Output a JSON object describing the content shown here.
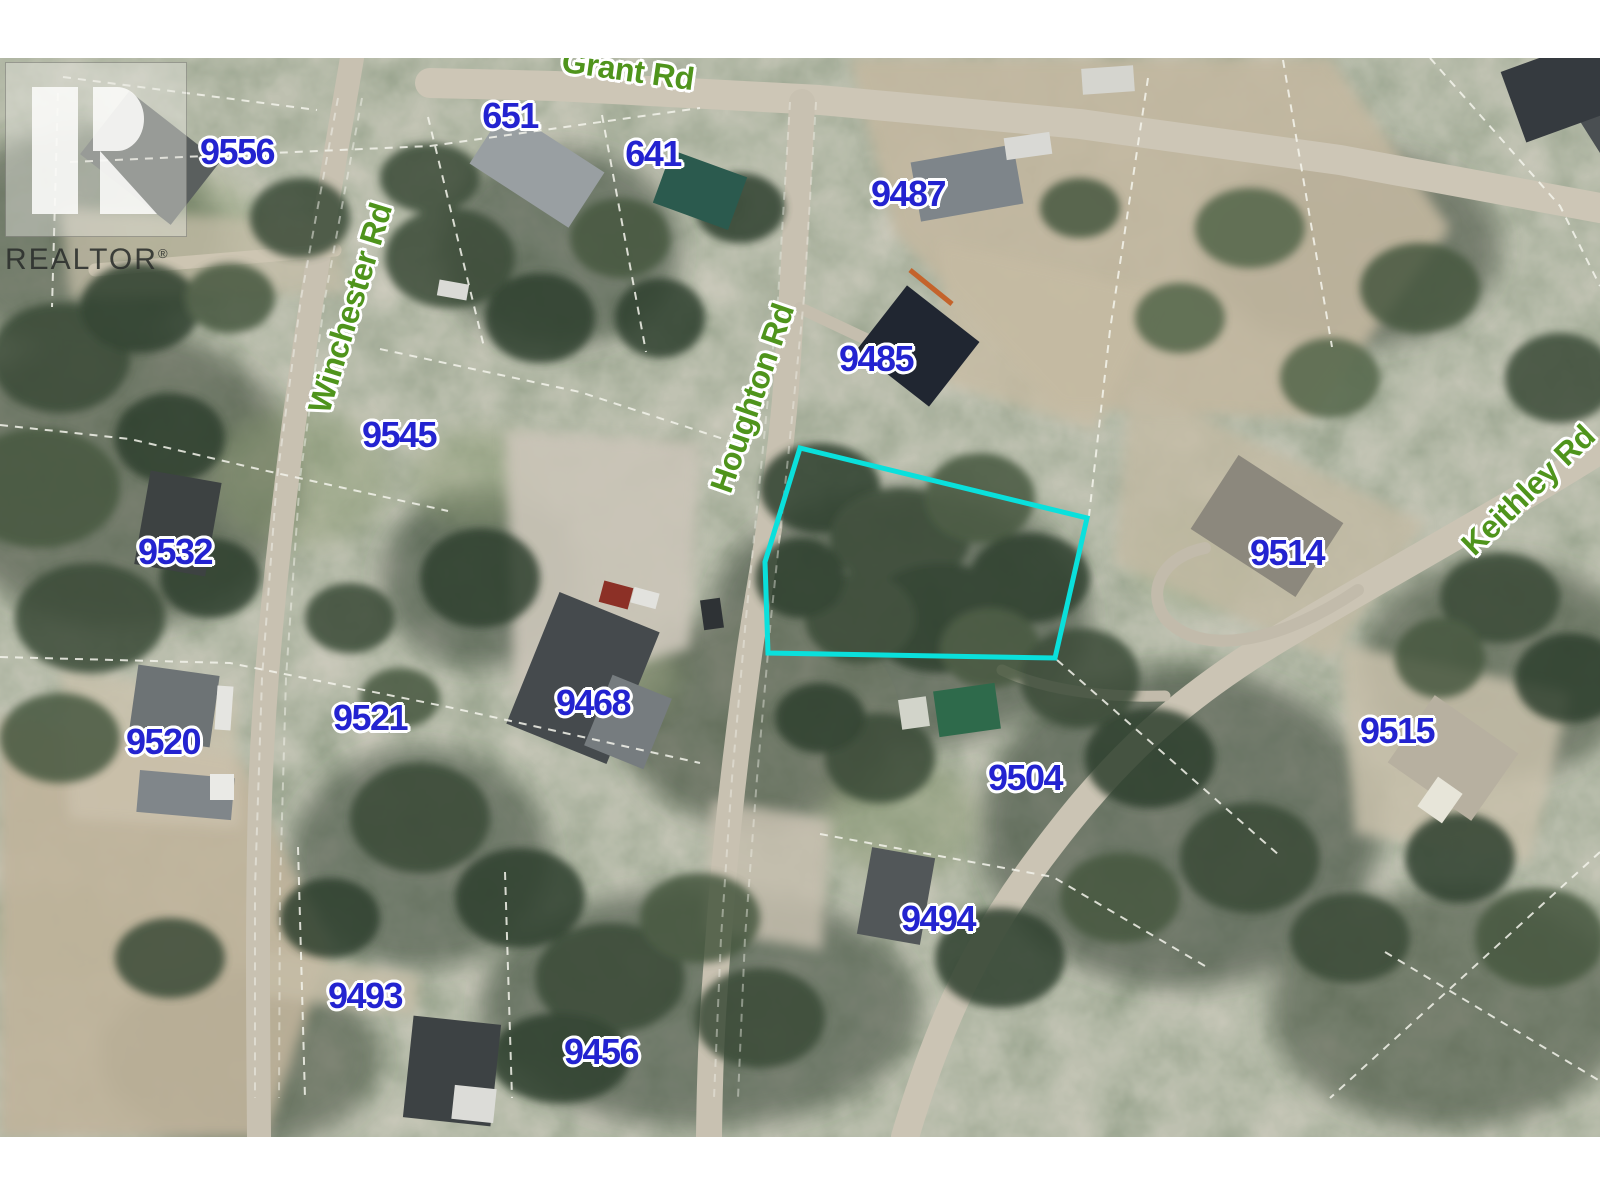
{
  "branding": {
    "logo_text": "REALTOR",
    "registered_mark": "®"
  },
  "map": {
    "type": "aerial-parcel-map",
    "label_colors": {
      "parcel": "#2323d0",
      "road": "#4f941c"
    },
    "highlight_parcel": {
      "color": "#0ae0dc",
      "points": "800,390 1087,460 1055,600 768,595 765,504"
    },
    "parcel_labels": [
      {
        "text": "9556",
        "x": 237,
        "y": 94
      },
      {
        "text": "651",
        "x": 510,
        "y": 58
      },
      {
        "text": "641",
        "x": 653,
        "y": 96
      },
      {
        "text": "9487",
        "x": 908,
        "y": 136
      },
      {
        "text": "9485",
        "x": 876,
        "y": 301
      },
      {
        "text": "9545",
        "x": 399,
        "y": 377
      },
      {
        "text": "9532",
        "x": 175,
        "y": 494
      },
      {
        "text": "9521",
        "x": 370,
        "y": 660
      },
      {
        "text": "9520",
        "x": 163,
        "y": 684
      },
      {
        "text": "9468",
        "x": 593,
        "y": 645
      },
      {
        "text": "9514",
        "x": 1287,
        "y": 495
      },
      {
        "text": "9515",
        "x": 1397,
        "y": 673
      },
      {
        "text": "9504",
        "x": 1025,
        "y": 720
      },
      {
        "text": "9494",
        "x": 938,
        "y": 861
      },
      {
        "text": "9493",
        "x": 365,
        "y": 938
      },
      {
        "text": "9456",
        "x": 601,
        "y": 994
      }
    ],
    "road_labels": [
      {
        "text": "Grant Rd",
        "x": 628,
        "y": 12,
        "rotation": 8
      },
      {
        "text": "Winchester Rd",
        "x": 350,
        "y": 250,
        "rotation": -73
      },
      {
        "text": "Houghton Rd",
        "x": 752,
        "y": 340,
        "rotation": -71
      },
      {
        "text": "Keithley Rd",
        "x": 1528,
        "y": 432,
        "rotation": -44
      }
    ]
  }
}
